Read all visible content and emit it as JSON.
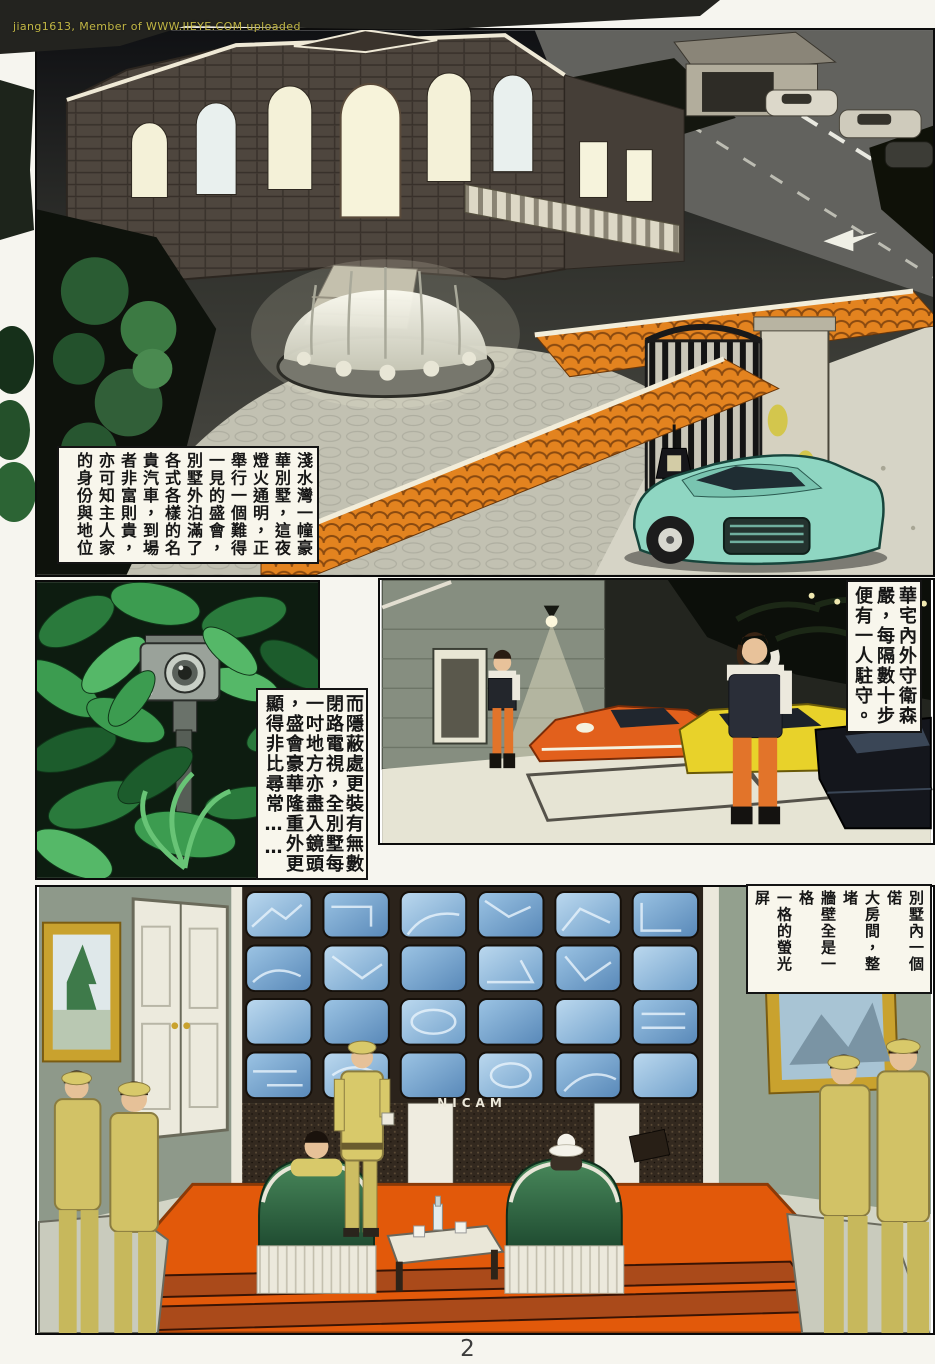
{
  "watermark": "jiang1613, Member of WWW.IIEYE.COM uploaded",
  "page_number": "2",
  "monitor_wall_label": "NICAM",
  "captions": {
    "panel1": {
      "columns": [
        "淺水灣一幢豪",
        "華別墅，這夜",
        "燈火通明，正",
        "舉行一個難得",
        "一見的盛會，",
        "別墅外泊滿了",
        "各式各樣的名",
        "貴汽車，到場",
        "者非富則貴，",
        "亦可知主人家",
        "的身份與地位"
      ],
      "text": "淺水灣一幢豪華別墅，這夜燈火通明，正舉行一個難得一見的盛會，別墅外泊滿了各式各樣的名貴汽車，到場者非富則貴，亦可知主人家的身份與地位"
    },
    "panel2": {
      "columns": [
        "而隱蔽處更裝有無數",
        "閉路電視，全別墅每",
        "一吋地方亦盡入鏡頭",
        "，盛會豪華隆重外更",
        "顯得非比尋常……"
      ],
      "text": "而隱蔽處更裝有無數閉路電視，全別墅每一吋地方亦盡入鏡頭，盛會豪華隆重外更顯得非比尋常……"
    },
    "panel3": {
      "columns": [
        "華宅內外守衛森",
        "嚴，每隔數十步",
        "便有一人駐守。"
      ],
      "text": "華宅內外守衛森嚴，每隔數十步便有一人駐守。"
    },
    "panel4": {
      "columns": [
        "別墅內一個偌",
        "大房間，整堵",
        "牆壁全是一格",
        "一格的螢光屏",
        "，守衛無數，",
        "兩張眞皮梳化",
        "上各坐着一男",
        "一女。"
      ],
      "text": "別墅內一個偌大房間，整堵牆壁全是一格一格的螢光屏，守衛無數，兩張眞皮梳化上各坐着一男一女。"
    }
  },
  "colors": {
    "roof_tile_orange": "#e3831f",
    "sports_car_teal": "#8fd6c2",
    "carpet_orange": "#e2590a",
    "monitor_blue": "#8fc3e8",
    "uniform_yellow": "#d8c96a",
    "guard_pants_orange": "#e2742a",
    "foliage_green": "#3c9c50",
    "watermark_yellow": "#cfc348"
  }
}
